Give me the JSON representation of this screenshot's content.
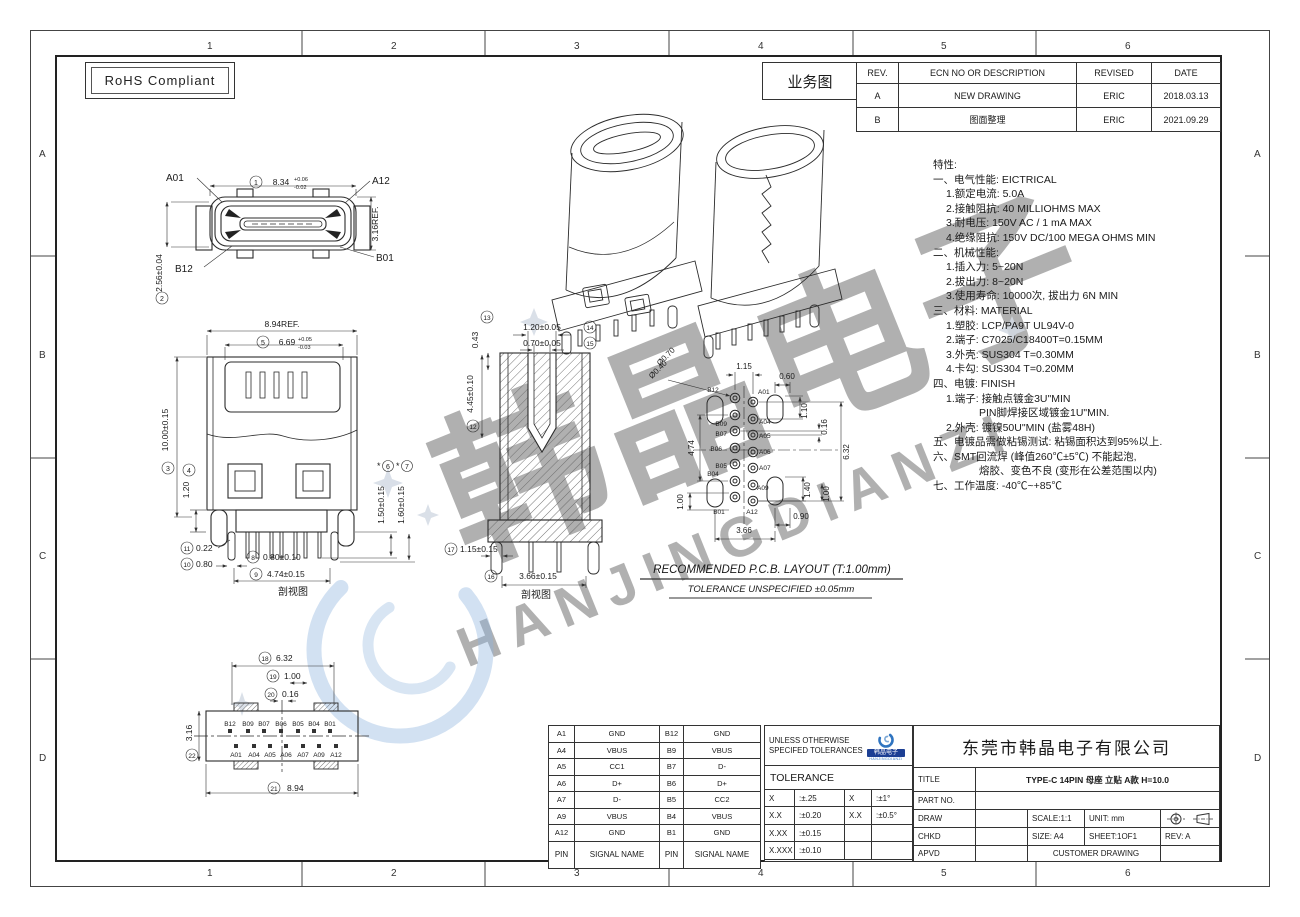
{
  "border": {
    "cols": [
      "1",
      "2",
      "3",
      "4",
      "5",
      "6"
    ],
    "rows": [
      "A",
      "B",
      "C",
      "D"
    ]
  },
  "rohs": {
    "label": "RoHS Compliant"
  },
  "revision": {
    "label": "业务图",
    "headers": [
      "REV.",
      "ECN NO OR DESCRIPTION",
      "REVISED",
      "DATE"
    ],
    "rows": [
      [
        "A",
        "NEW DRAWING",
        "ERIC",
        "2018.03.13"
      ],
      [
        "B",
        "图面整理",
        "ERIC",
        "2021.09.29"
      ]
    ]
  },
  "specs": {
    "lines": [
      "特性:",
      "一、电气性能: EICTRICAL",
      "1.额定电流: 5.0A",
      "2.接触阻抗: 40  MILLIOHMS  MAX",
      "3.耐电压: 150V  AC  /  1  mA  MAX",
      "4.绝缘阻抗: 150V  DC/100  MEGA  OHMS  MIN",
      "二、机械性能:",
      "1.插入力: 5~20N",
      "2.拔出力: 8~20N",
      "3.使用寿命: 10000次, 拔出力 6N  MIN",
      "三、材料: MATERIAL",
      "1.塑胶: LCP/PA9T  UL94V-0",
      "2.端子: C7025/C18400T=0.15MM",
      "3.外壳: SUS304  T=0.30MM",
      "4.卡勾: SUS304  T=0.20MM",
      "四、电镀: FINISH",
      "1.端子: 接触点镀金3U\"MIN",
      "PIN脚焊接区域镀金1U\"MIN.",
      "2.外壳: 镀镍50U\"MIN (盐雾48H)",
      "五、电镀品需做粘锡测试: 粘锡面积达到95%以上.",
      "六、SMT回流焊 (峰值260℃±5℃) 不能起泡,",
      "熔胶、变色不良 (变形在公差范围以内)",
      "七、工作温度: -40℃~+85℃"
    ]
  },
  "views": {
    "front": {
      "pins": {
        "a01": "A01",
        "a12": "A12",
        "b12": "B12",
        "b01": "B01"
      },
      "d1": {
        "n": "1",
        "v": "8.34",
        "tp": "+0.06",
        "tm": "-0.02"
      },
      "d2": {
        "n": "2",
        "v": "2.56±0.04"
      },
      "ref": "3.16REF."
    },
    "elev": {
      "w": "8.94REF.",
      "d5": {
        "n": "5",
        "v": "6.69",
        "tp": "+0.05",
        "tm": "-0.03"
      },
      "d3": {
        "n": "3",
        "v": "10.00±0.15"
      },
      "d4": {
        "n": "4",
        "v": "1.20"
      },
      "d6": {
        "n": "6",
        "v": "1.50±0.15",
        "star": "*"
      },
      "d7": {
        "n": "7",
        "v": "1.60±0.15",
        "star": "*"
      },
      "d8": {
        "n": "8",
        "v": "0.80±0.10"
      },
      "d9": {
        "n": "9",
        "v": "4.74±0.15"
      },
      "d10": {
        "n": "10",
        "v": "0.80"
      },
      "d11": {
        "n": "11",
        "v": "0.22"
      },
      "caption": "剖视图"
    },
    "section": {
      "d12": {
        "n": "12",
        "v": "4.45±0.10"
      },
      "d13": {
        "n": "13",
        "v": "0.43"
      },
      "d14": {
        "n": "14",
        "v": "1.20±0.05"
      },
      "d15": {
        "n": "15",
        "v": "0.70±0.05"
      },
      "d16": {
        "n": "16",
        "v": "3.66±0.15"
      },
      "d17": {
        "n": "17",
        "v": "1.15±0.15"
      },
      "caption": "剖视图"
    },
    "bottom": {
      "d18": {
        "n": "18",
        "v": "6.32"
      },
      "d19": {
        "n": "19",
        "v": "1.00"
      },
      "d20": {
        "n": "20",
        "v": "0.16"
      },
      "d21": {
        "n": "21",
        "v": "8.94"
      },
      "d22": {
        "n": "22",
        "v": "3.16"
      },
      "pins_b": [
        "B12",
        "B09",
        "B07",
        "B06",
        "B05",
        "B04",
        "B01"
      ],
      "pins_a": [
        "A01",
        "A04",
        "A05",
        "A06",
        "A07",
        "A09",
        "A12"
      ]
    },
    "pcb": {
      "dia1": "Ø0.70",
      "dia2": "Ø0.40",
      "d_115": "1.15",
      "d_060": "0.60",
      "d_110": "1.10",
      "d_016": "0.16",
      "d_632": "6.32",
      "d_474": "4.74",
      "d_100l": "1.00",
      "d_140": "1.40",
      "d_100r": "1.00",
      "d_090": "0.90",
      "d_366": "3.66",
      "pins_b": [
        "B12",
        "B09",
        "B07",
        "B06",
        "B05",
        "B04",
        "B01"
      ],
      "pins_a": [
        "A01",
        "A04",
        "A05",
        "A06",
        "A07",
        "A09",
        "A12"
      ],
      "title": "RECOMMENDED   P.C.B.  LAYOUT  (T:1.00mm)",
      "tolerance": "TOLERANCE  UNSPECIFIED  ±0.05mm"
    }
  },
  "pin_table": {
    "rows": [
      [
        "A1",
        "GND",
        "B12",
        "GND"
      ],
      [
        "A4",
        "VBUS",
        "B9",
        "VBUS"
      ],
      [
        "A5",
        "CC1",
        "B7",
        "D-"
      ],
      [
        "A6",
        "D+",
        "B6",
        "D+"
      ],
      [
        "A7",
        "D-",
        "B5",
        "CC2"
      ],
      [
        "A9",
        "VBUS",
        "B4",
        "VBUS"
      ],
      [
        "A12",
        "GND",
        "B1",
        "GND"
      ],
      [
        "PIN",
        "SIGNAL NAME",
        "PIN",
        "SIGNAL NAME"
      ]
    ]
  },
  "tolerance_block": {
    "line1": "UNLESS OTHERWISE",
    "line2": "SPECIFED TOLERANCES",
    "title": "TOLERANCE",
    "rows": [
      [
        "X",
        ":±.25",
        "X",
        ":±1°"
      ],
      [
        "X.X",
        ":±0.20",
        "X.X",
        ":±0.5°"
      ],
      [
        "X.XX",
        ":±0.15",
        "",
        ""
      ],
      [
        "X.XXX",
        ":±0.10",
        "",
        ""
      ]
    ]
  },
  "title_block": {
    "company": "东莞市韩晶电子有限公司",
    "title_label": "TITLE",
    "title_value": "TYPE-C 14PIN 母座 立贴 A款  H=10.0",
    "part_label": "PART NO.",
    "draw_label": "DRAW",
    "chkd_label": "CHKD",
    "apvd_label": "APVD",
    "scale": "SCALE:1:1",
    "unit": "UNIT:  mm",
    "size": "SIZE:  A4",
    "sheet": "SHEET:1OF1",
    "rev": "REV: A",
    "customer": "CUSTOMER DRAWING"
  },
  "logo": {
    "name": "韩晶电子",
    "sub": "HANJINGDIANZI"
  },
  "watermark": {
    "cn": "韩晶电子",
    "en": "HANJINGDIANZI"
  }
}
